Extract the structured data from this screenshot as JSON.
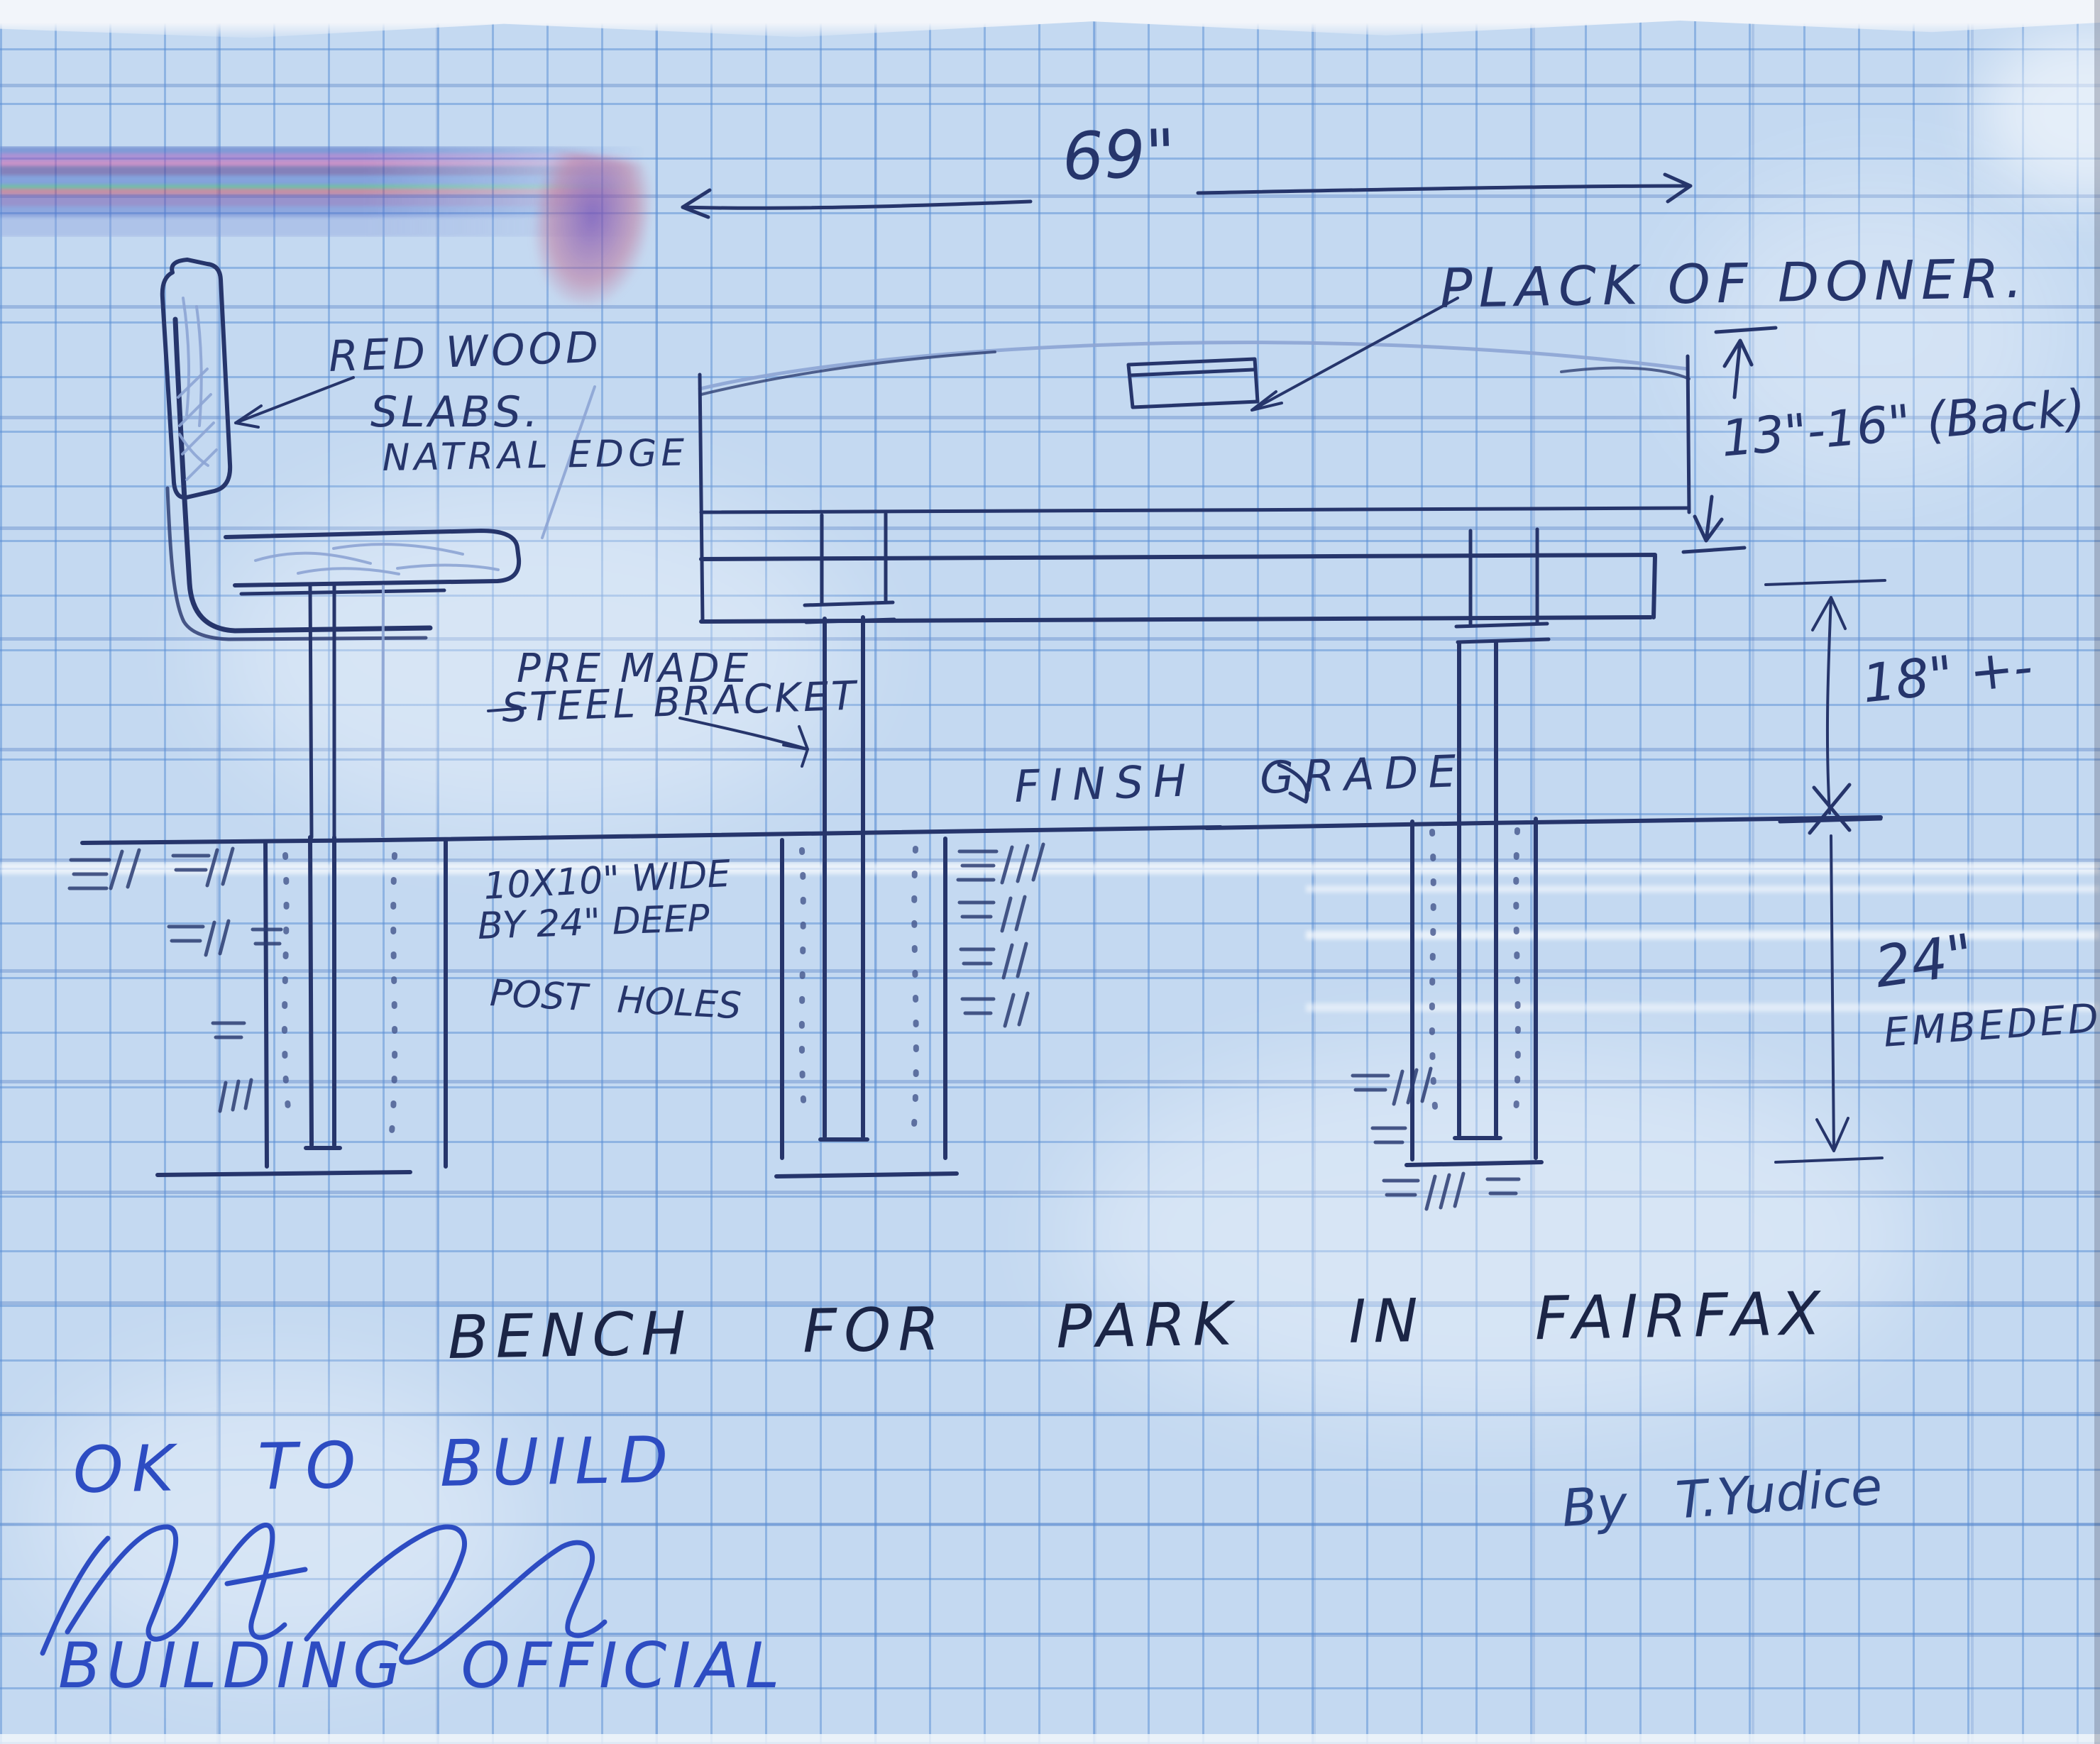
{
  "labels": {
    "overall_width": "69\"",
    "plaque": "PLACK OF DONER.",
    "material_line1": "RED WOOD",
    "material_line2": "SLABS.",
    "material_line3": "NATRAL EDGE",
    "back_height": "13\"-16\" (Back)",
    "bracket_line1": "PRE MADE",
    "bracket_line2": "STEEL BRACKET",
    "grade": "FINSH GRADE",
    "seat_height": "18\" +-",
    "hole_line1": "10X10\" WIDE",
    "hole_line2": "BY 24\" DEEP",
    "hole_line3": "POST HOLES",
    "embed_depth": "24\"",
    "embed_word": "EMBEDED",
    "title": "BENCH FOR PARK IN FAIRFAX",
    "approval": "OK TO BUILD",
    "approver_title": "BUILDING OFFICIAL",
    "credit": "By T.Yudice"
  },
  "colors": {
    "paper": "#c4d9f1",
    "grid_line": "#7fadde",
    "ink_dark": "#26356b",
    "pen_blue": "#2d4cc2",
    "pencil": "#8da4d4"
  }
}
